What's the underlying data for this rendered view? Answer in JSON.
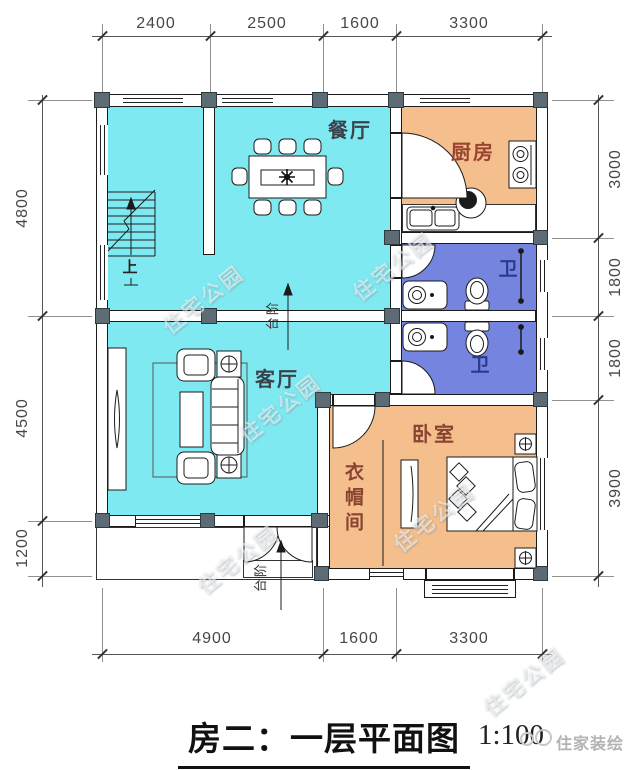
{
  "title": {
    "text": "房二：一层平面图",
    "scale": "1:100"
  },
  "rooms": {
    "dining": "餐厅",
    "kitchen": "厨房",
    "bath_upper": "卫",
    "bath_lower": "卫",
    "living": "客厅",
    "bedroom": "卧室",
    "cloakroom": "衣帽间"
  },
  "annotations": {
    "stairs_up": "上",
    "steps": "台阶"
  },
  "dims": {
    "top": [
      "2400",
      "2500",
      "1600",
      "3300"
    ],
    "left": [
      "4800",
      "4500",
      "1200"
    ],
    "right": [
      "3000",
      "1800",
      "1800",
      "3900"
    ],
    "bottom": [
      "4900",
      "1600",
      "3300"
    ]
  },
  "watermark": {
    "pattern": "住宅公园",
    "brand": "住家装绘"
  },
  "colors": {
    "floor_cyan": "#7FE9F2",
    "floor_orange": "#F4BF8C",
    "floor_blue": "#7585DF",
    "wall_fill": "#FFFFFF",
    "column": "#5D6B75",
    "outline": "#1A1A1A"
  }
}
